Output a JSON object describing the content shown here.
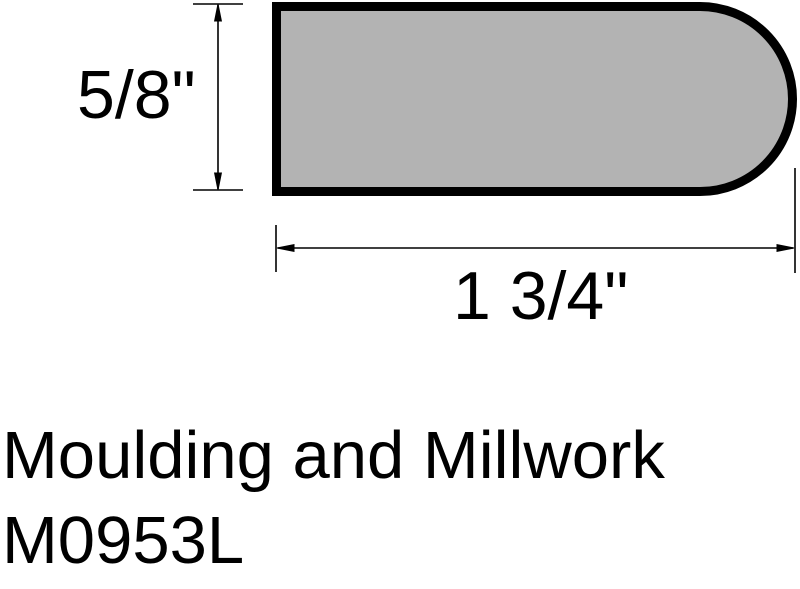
{
  "drawing": {
    "type": "moulding-profile-cross-section",
    "dimensions": {
      "height_label": "5/8\"",
      "width_label": "1 3/4\""
    },
    "colors": {
      "profile_fill": "#b3b3b3",
      "line_color": "#000000",
      "background": "#ffffff"
    }
  },
  "title": {
    "line1": "Moulding and Millwork",
    "line2": "M0953L"
  }
}
